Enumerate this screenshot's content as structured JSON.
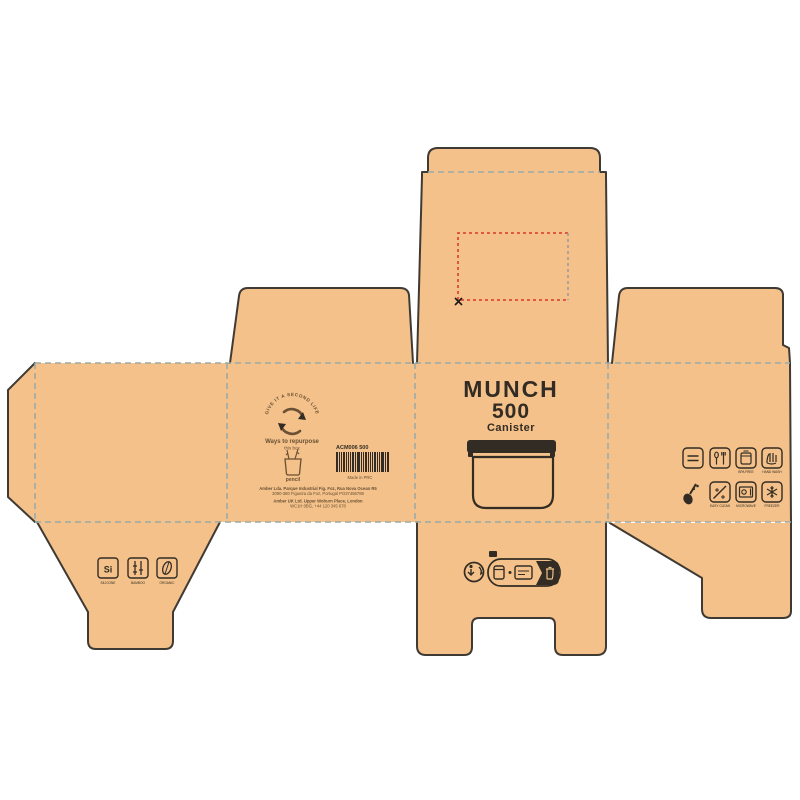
{
  "document": {
    "kind": "packaging-dieline"
  },
  "front_panel": {
    "title_line1": "MUNCH",
    "title_line2": "500",
    "subtitle": "Canister"
  },
  "lid_panel": {
    "placement_marker": "X"
  },
  "back_panel": {
    "logo_arc_text": "GIVE IT A SECOND LIFE",
    "repurpose_heading": "Ways to repurpose",
    "repurpose_sub": "this box",
    "repurpose_item_label": "pencil",
    "barcode_code": "ACM006 500",
    "barcode_pattern": [
      2,
      1,
      1,
      2,
      1,
      1,
      1,
      2,
      1,
      3,
      1,
      1,
      2,
      1,
      1,
      1,
      2,
      1,
      1,
      3,
      1,
      2
    ],
    "made_in": "Made in PRC",
    "address_line1": "Amber Lda. Parque Industrial Fig. Foz, Rua Nova Ocean R5",
    "address_line2": "3090-380 Figueira da Foz, Portugal PO37456789",
    "address_line3": "Amber UK Ltd. Upper Woburn Place, London",
    "address_line4": "WC1H 0BG, +44 120 345 678"
  },
  "material_icons": {
    "icon1_text": "Si",
    "icon1_caption": "SILICONE",
    "icon2_caption": "BAMBOO",
    "icon3_caption": "ORGANIC"
  },
  "care_icons": {
    "row1_cap3": "BPA FREE",
    "row1_cap4": "HAND WASH",
    "row2_cap2": "EASY CLEAN",
    "row2_cap3": "MICROWAVE",
    "row2_cap4": "FREEZER"
  },
  "colors": {
    "kraft": "#f3c189",
    "cut": "#3f3a34",
    "fold": "#9aaba9",
    "ink": "#332c24",
    "brown": "#6a5034",
    "red": "#d9392b",
    "graydash": "#9a9a9a",
    "paper": "#ffffff"
  }
}
